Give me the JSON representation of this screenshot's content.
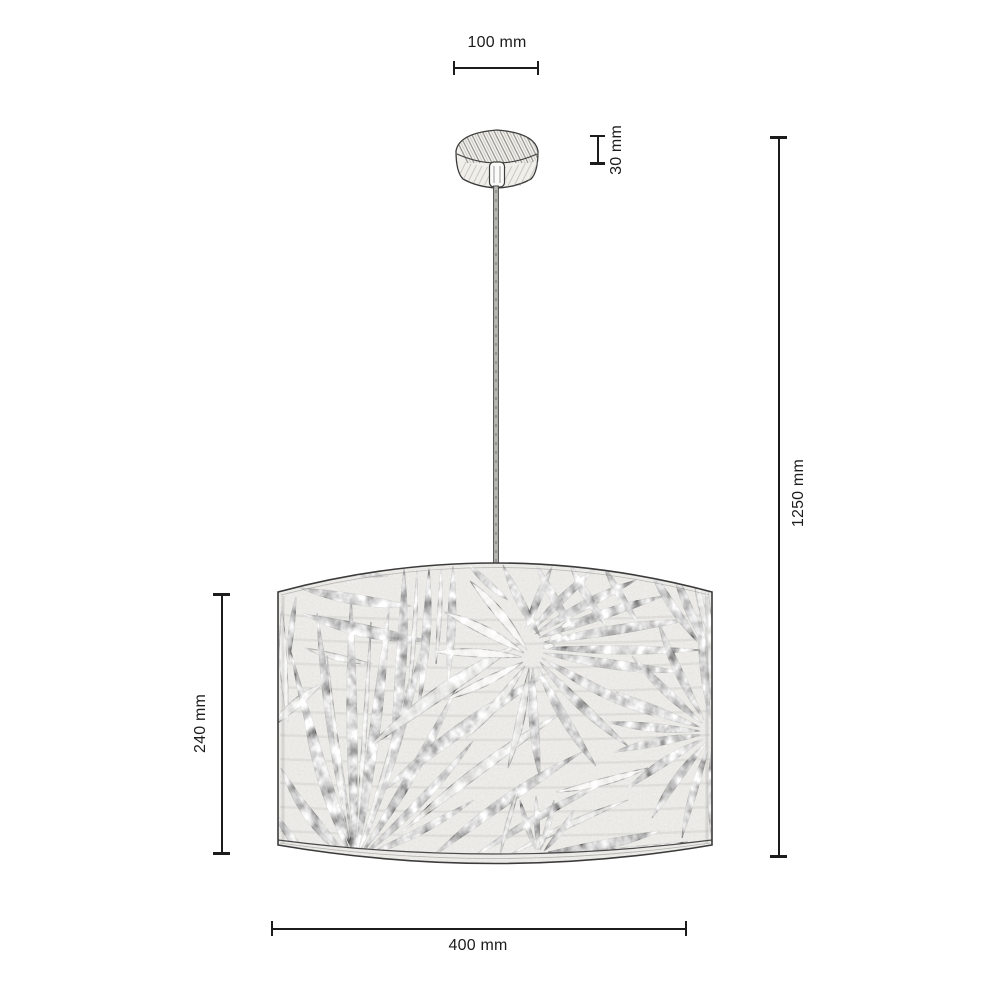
{
  "diagram": {
    "title": "pendant-lamp-dimension-diagram",
    "product": "pendant lamp with leaf-print drum shade and wooden ceiling canopy",
    "dimensions": {
      "canopy_width": "100 mm",
      "canopy_height": "30 mm",
      "total_height": "1250 mm",
      "shade_height": "240 mm",
      "shade_diameter": "400 mm"
    },
    "colors": {
      "ink": "#1c1c1c",
      "outline": "#3b3b3b",
      "shade_fill": "#f7f6f2",
      "canopy_fill": "#f1efe9",
      "cable_fill": "#b9b7b2",
      "leaf_dark": "#7a7a7a",
      "leaf_medium": "#9c9c9c",
      "leaf_light": "#c5c4bf",
      "leaf_pale": "#e9e7e2"
    }
  }
}
